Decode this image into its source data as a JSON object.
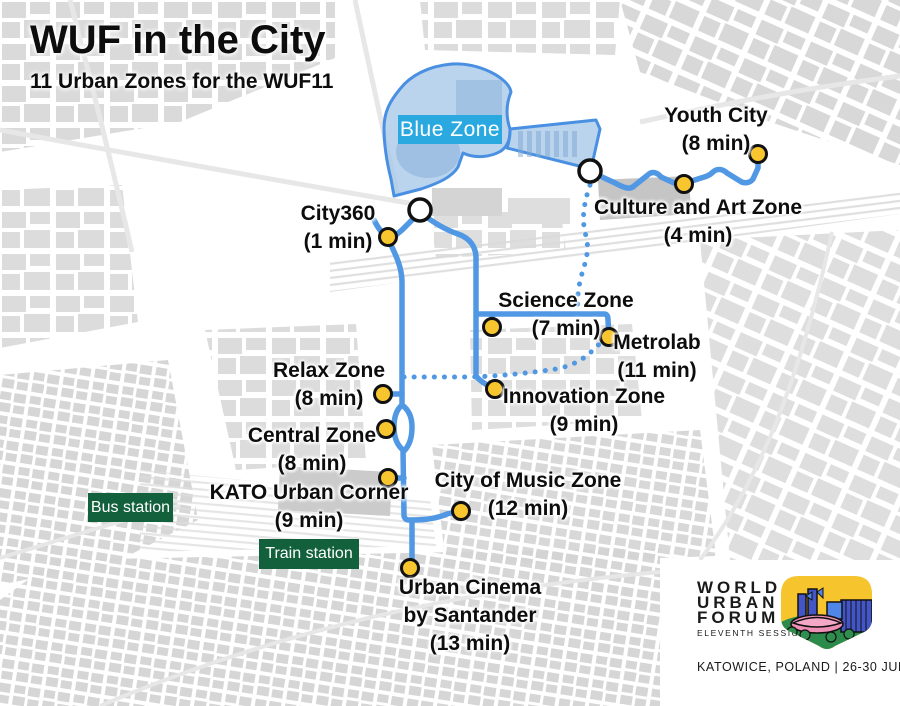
{
  "title": "WUF in the City",
  "subtitle": "11 Urban Zones for the WUF11",
  "blue_zone": {
    "label": "Blue Zone"
  },
  "zones": [
    {
      "id": "city360",
      "name": "City360",
      "time": "(1 min)"
    },
    {
      "id": "youth-city",
      "name": "Youth City",
      "time": "(8 min)"
    },
    {
      "id": "culture-art",
      "name": "Culture and Art Zone",
      "time": "(4 min)"
    },
    {
      "id": "science",
      "name": "Science Zone",
      "time": "(7 min)"
    },
    {
      "id": "metrolab",
      "name": "Metrolab",
      "time": "(11 min)"
    },
    {
      "id": "innovation",
      "name": "Innovation Zone",
      "time": "(9 min)"
    },
    {
      "id": "relax",
      "name": "Relax Zone",
      "time": "(8 min)"
    },
    {
      "id": "central",
      "name": "Central Zone",
      "time": "(8 min)"
    },
    {
      "id": "kato",
      "name": "KATO Urban Corner",
      "time": "(9 min)"
    },
    {
      "id": "city-of-music",
      "name": "City of Music Zone",
      "time": "(12 min)"
    },
    {
      "id": "urban-cinema",
      "name": "Urban Cinema",
      "name2": "by Santander",
      "time": "(13 min)"
    }
  ],
  "stations": {
    "bus": "Bus station",
    "train": "Train station"
  },
  "logo": {
    "line1": "WORLD",
    "line2": "URBAN",
    "line3": "FORUM",
    "session": "ELEVENTH SESSION",
    "footer": "KATOWICE, POLAND | 26-30 JUNE 2022"
  },
  "colors": {
    "route_blue": "#5097e4",
    "blue_zone_fill": "#a9c9ea",
    "blue_zone_stroke": "#4a90e2",
    "blue_zone_label_bg": "#2aa9e0",
    "marker_yellow": "#f7c52e",
    "station_green": "#13603c",
    "map_block_gray": "#d8d8d8"
  }
}
